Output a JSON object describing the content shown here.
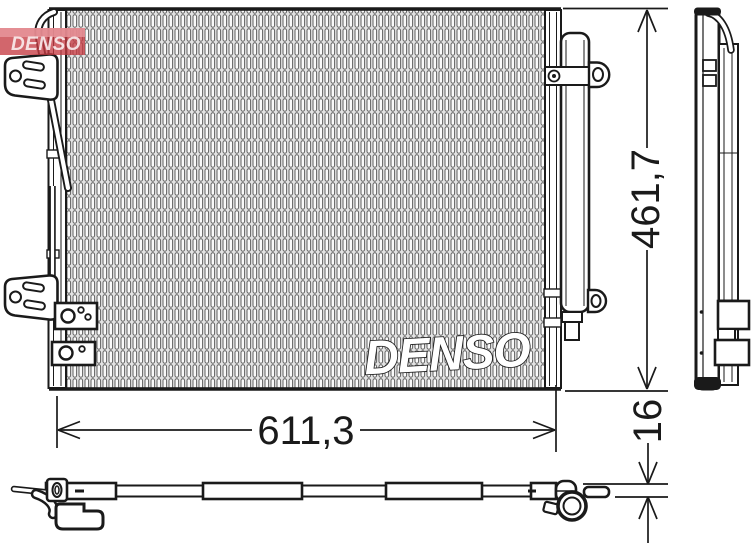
{
  "drawing": {
    "dimensions": {
      "width_label": "611,3",
      "height_label": "461,7",
      "depth_label": "16"
    },
    "core_watermark": "DENSO",
    "brand_logo": {
      "text": "DENSO",
      "red": "#c53b43",
      "light_red": "#e9989f"
    },
    "colors": {
      "line": "#1a1a1a",
      "background": "#ffffff",
      "fin_fill": "#e3e3e3",
      "fin_stroke": "#606060"
    }
  }
}
